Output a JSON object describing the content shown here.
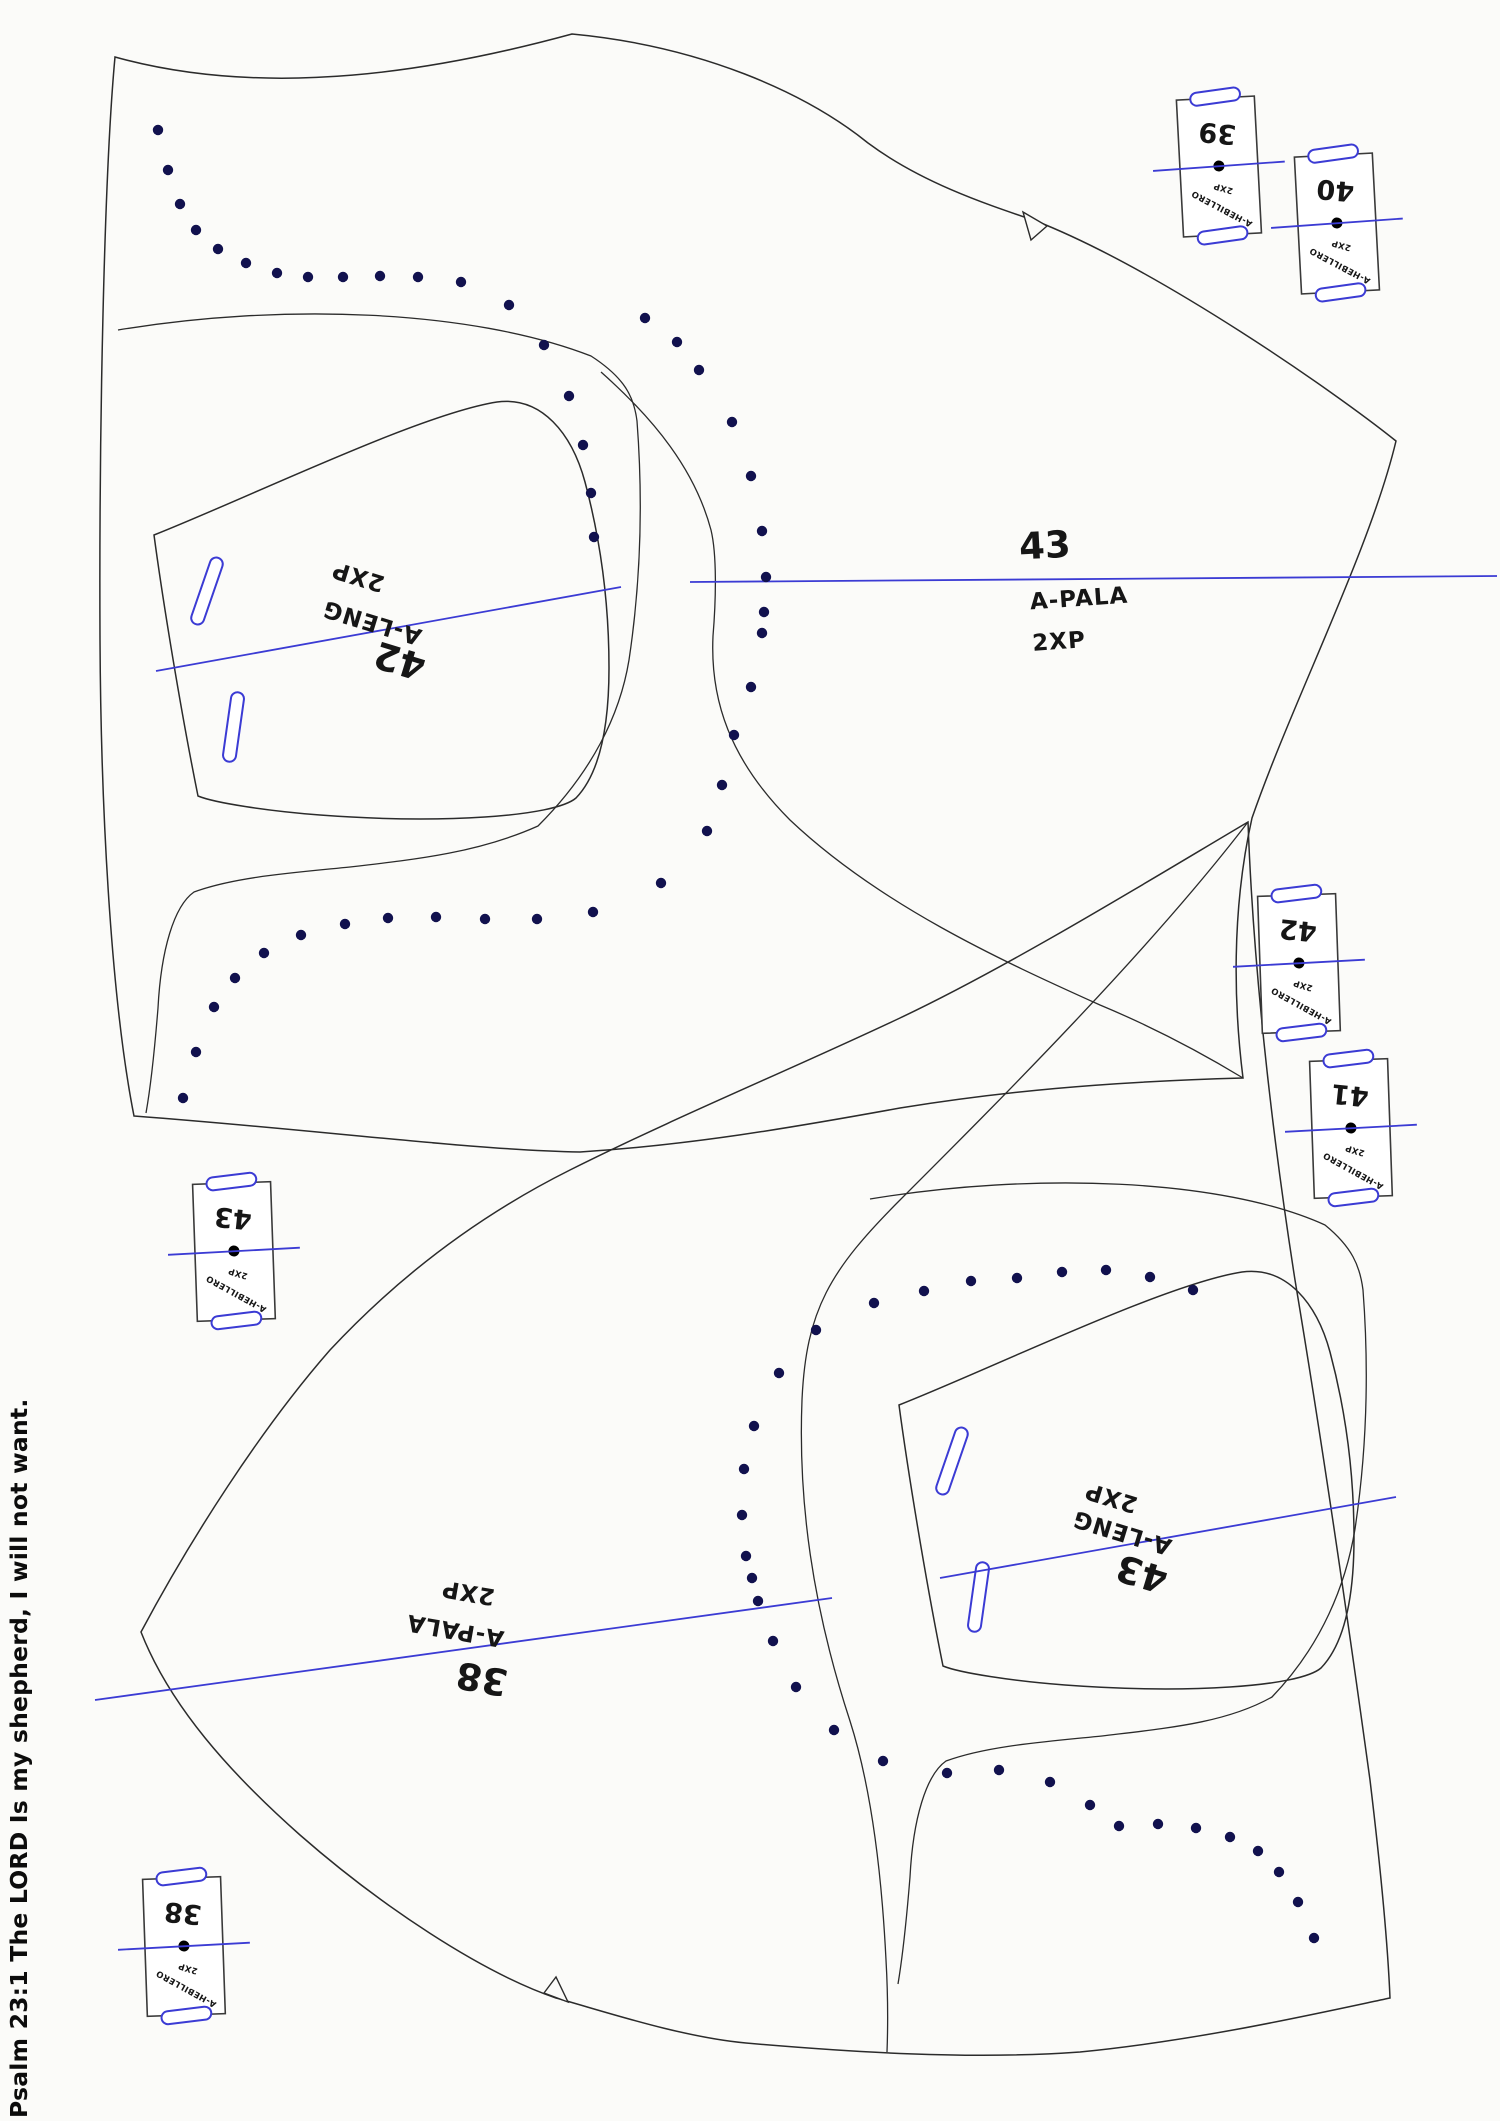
{
  "document": {
    "footer_vertical_text": "Psalm 23:1 The LORD Is my shepherd, I will not want."
  },
  "colors": {
    "outline": "#2b2b2b",
    "marking_blue": "#3b3bd4",
    "stitch_dot": "#11114e",
    "background": "#fbfbf9"
  },
  "pieces": {
    "vamp_top": {
      "number": "43",
      "name": "A-PALA",
      "quantity": "2XP"
    },
    "tongue_top": {
      "number": "42",
      "name": "A-LENG",
      "quantity": "2XP"
    },
    "vamp_bottom": {
      "number": "38",
      "name": "A-PALA",
      "quantity": "2XP"
    },
    "tongue_bottom": {
      "number": "43",
      "name": "A-LENG",
      "quantity": "2XP"
    }
  },
  "straps": [
    {
      "number": "39",
      "name": "A-HEBILLERO",
      "quantity": "2XP"
    },
    {
      "number": "40",
      "name": "A-HEBILLERO",
      "quantity": "2XP"
    },
    {
      "number": "42",
      "name": "A-HEBILLERO",
      "quantity": "2XP"
    },
    {
      "number": "41",
      "name": "A-HEBILLERO",
      "quantity": "2XP"
    },
    {
      "number": "43",
      "name": "A-HEBILLERO",
      "quantity": "2XP"
    },
    {
      "number": "38",
      "name": "A-HEBILLERO",
      "quantity": "2XP"
    }
  ],
  "stitch_dots": {
    "top_piece": [
      [
        158,
        130
      ],
      [
        168,
        170
      ],
      [
        180,
        204
      ],
      [
        196,
        230
      ],
      [
        218,
        249
      ],
      [
        246,
        263
      ],
      [
        277,
        273
      ],
      [
        308,
        277
      ],
      [
        343,
        277
      ],
      [
        380,
        276
      ],
      [
        418,
        277
      ],
      [
        461,
        282
      ],
      [
        509,
        305
      ],
      [
        544,
        345
      ],
      [
        569,
        396
      ],
      [
        583,
        445
      ],
      [
        591,
        493
      ],
      [
        594,
        537
      ],
      [
        645,
        318
      ],
      [
        677,
        342
      ],
      [
        699,
        370
      ],
      [
        732,
        422
      ],
      [
        751,
        476
      ],
      [
        762,
        531
      ],
      [
        766,
        577
      ],
      [
        764,
        612
      ],
      [
        762,
        633
      ],
      [
        751,
        687
      ],
      [
        734,
        735
      ],
      [
        722,
        785
      ],
      [
        707,
        831
      ],
      [
        661,
        883
      ],
      [
        593,
        912
      ],
      [
        537,
        919
      ],
      [
        485,
        919
      ],
      [
        436,
        917
      ],
      [
        388,
        918
      ],
      [
        345,
        924
      ],
      [
        301,
        935
      ],
      [
        264,
        953
      ],
      [
        235,
        978
      ],
      [
        214,
        1007
      ],
      [
        196,
        1052
      ],
      [
        183,
        1098
      ]
    ],
    "bottom_piece": [
      [
        1193,
        1290
      ],
      [
        1150,
        1277
      ],
      [
        1106,
        1270
      ],
      [
        1062,
        1272
      ],
      [
        1017,
        1278
      ],
      [
        971,
        1281
      ],
      [
        924,
        1291
      ],
      [
        874,
        1303
      ],
      [
        816,
        1330
      ],
      [
        779,
        1373
      ],
      [
        754,
        1426
      ],
      [
        744,
        1469
      ],
      [
        742,
        1515
      ],
      [
        746,
        1556
      ],
      [
        752,
        1578
      ],
      [
        758,
        1601
      ],
      [
        773,
        1641
      ],
      [
        796,
        1687
      ],
      [
        834,
        1730
      ],
      [
        883,
        1761
      ],
      [
        947,
        1773
      ],
      [
        999,
        1770
      ],
      [
        1050,
        1782
      ],
      [
        1090,
        1805
      ],
      [
        1119,
        1826
      ],
      [
        1158,
        1824
      ],
      [
        1196,
        1828
      ],
      [
        1230,
        1837
      ],
      [
        1258,
        1851
      ],
      [
        1279,
        1872
      ],
      [
        1298,
        1902
      ],
      [
        1314,
        1938
      ]
    ]
  }
}
